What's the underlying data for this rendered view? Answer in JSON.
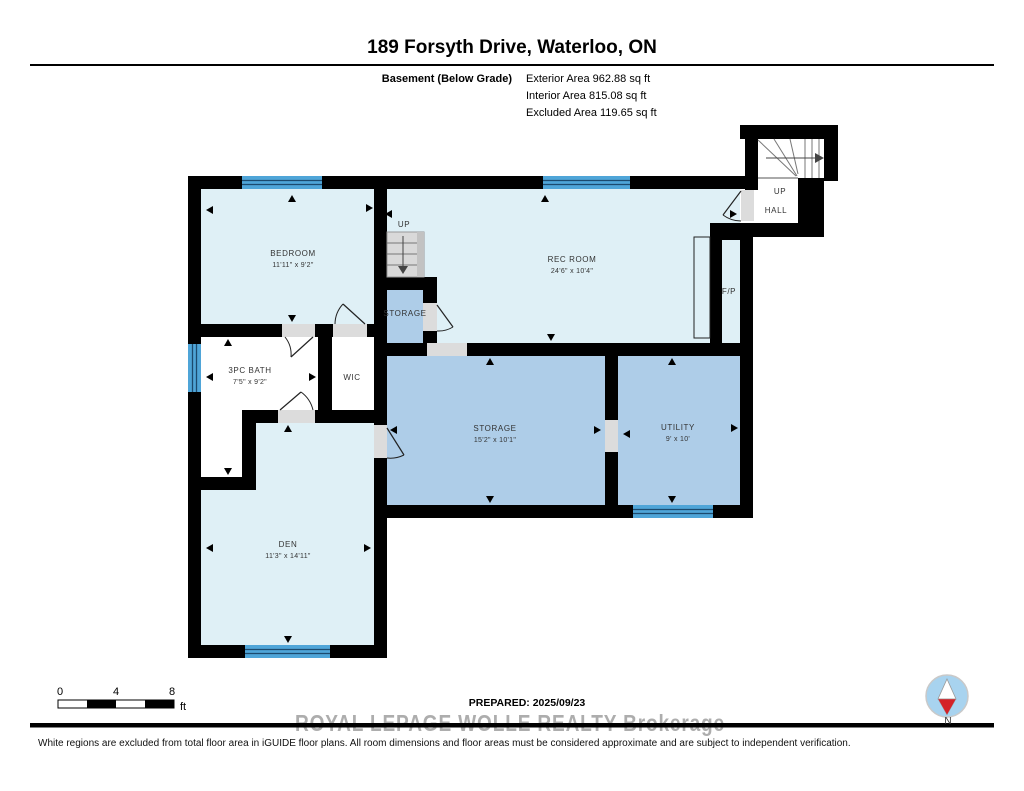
{
  "page": {
    "title": "189 Forsyth Drive, Waterloo, ON",
    "floor_label": "Basement (Below Grade)",
    "areas": {
      "exterior": "Exterior Area 962.88 sq ft",
      "interior": "Interior Area 815.08 sq ft",
      "excluded": "Excluded Area 119.65 sq ft"
    }
  },
  "plan": {
    "rooms": {
      "bedroom": {
        "name": "BEDROOM",
        "dims": "11'11\" x 9'2\""
      },
      "rec_room": {
        "name": "REC ROOM",
        "dims": "24'6\" x 10'4\""
      },
      "bath": {
        "name": "3PC BATH",
        "dims": "7'5\" x 9'2\""
      },
      "wic": {
        "name": "WIC"
      },
      "storage_small": {
        "name": "STORAGE"
      },
      "storage": {
        "name": "STORAGE",
        "dims": "15'2\" x 10'1\""
      },
      "utility": {
        "name": "UTILITY",
        "dims": "9' x 10'"
      },
      "den": {
        "name": "DEN",
        "dims": "11'3\" x 14'11\""
      },
      "fireplace": {
        "name": "F/P"
      }
    },
    "labels": {
      "stairs_up": "UP",
      "entry_up": "UP",
      "entry_hall": "HALL"
    }
  },
  "footer": {
    "scale": {
      "tick0": "0",
      "tick4": "4",
      "tick8": "8",
      "unit": "ft"
    },
    "prepared": "PREPARED: 2025/09/23",
    "watermark": "ROYAL LEPAGE WOLLE REALTY Brokerage",
    "disclaimer": "White regions are excluded from total floor area in iGUIDE floor plans. All room dimensions and floor areas must be considered approximate and are subject to independent verification.",
    "compass_label": "N"
  },
  "colors": {
    "wall": "#000000",
    "room_light": "#DFF0F6",
    "room_medium": "#AECDE8",
    "window_blue": "#4FA5D8",
    "door_gray": "#DCDCDC",
    "stair_gray": "#D9D9D9",
    "compass_fill": "#A8D3EF",
    "compass_red": "#D42127"
  }
}
